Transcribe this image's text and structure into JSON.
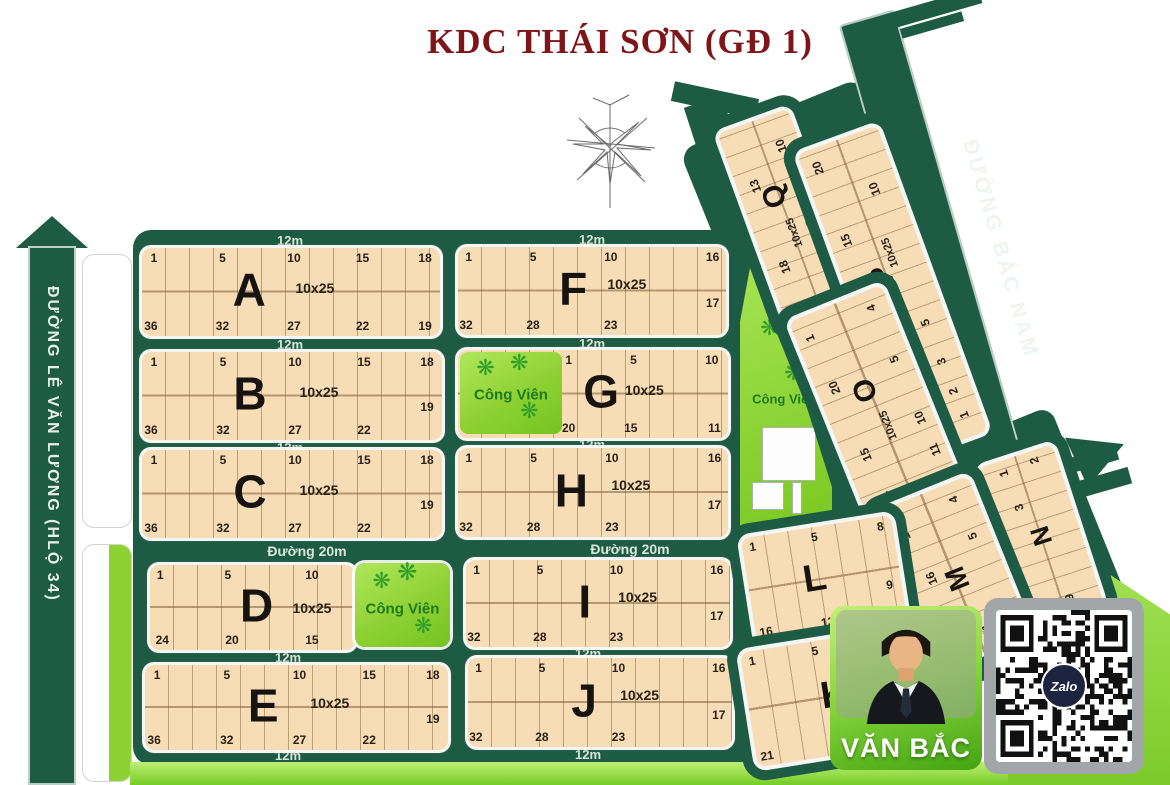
{
  "title": "KDC THÁI SƠN (GĐ 1)",
  "roads": {
    "le_van_luong": "ĐƯỜNG LÊ VĂN LƯƠNG (HLỘ 34)",
    "bac_nam": "ĐƯỜNG BẮC NAM",
    "duong_20m": "Đường 20m",
    "w12m": "12m"
  },
  "park_label": "Công Viên",
  "blocks": {
    "A": {
      "label": "A",
      "size": "10x25",
      "top": [
        "1",
        "5",
        "10",
        "15",
        "18"
      ],
      "bottom": [
        "36",
        "32",
        "27",
        "22",
        "19"
      ]
    },
    "B": {
      "label": "B",
      "size": "10x25",
      "top": [
        "1",
        "5",
        "10",
        "15",
        "18"
      ],
      "bottom": [
        "36",
        "32",
        "27",
        "22",
        "19"
      ]
    },
    "C": {
      "label": "C",
      "size": "10x25",
      "top": [
        "1",
        "5",
        "10",
        "15",
        "18"
      ],
      "bottom": [
        "36",
        "32",
        "27",
        "22",
        "19"
      ]
    },
    "D": {
      "label": "D",
      "size": "10x25",
      "top": [
        "1",
        "5",
        "10"
      ],
      "bottom": [
        "24",
        "20",
        "15"
      ]
    },
    "E": {
      "label": "E",
      "size": "10x25",
      "top": [
        "1",
        "5",
        "10",
        "15",
        "18"
      ],
      "bottom": [
        "36",
        "32",
        "27",
        "22",
        "19"
      ]
    },
    "F": {
      "label": "F",
      "size": "10x25",
      "top": [
        "1",
        "5",
        "10",
        "16"
      ],
      "bottom": [
        "32",
        "28",
        "23",
        "17"
      ]
    },
    "G": {
      "label": "G",
      "size": "10x25",
      "top": [
        "1",
        "5",
        "10"
      ],
      "bottom": [
        "20",
        "15",
        "11"
      ]
    },
    "H": {
      "label": "H",
      "size": "10x25",
      "top": [
        "1",
        "5",
        "10",
        "16"
      ],
      "bottom": [
        "32",
        "28",
        "23",
        "17"
      ]
    },
    "I": {
      "label": "I",
      "size": "10x25",
      "top": [
        "1",
        "5",
        "10",
        "16"
      ],
      "bottom": [
        "32",
        "28",
        "23",
        "17"
      ]
    },
    "J": {
      "label": "J",
      "size": "10x25",
      "top": [
        "1",
        "5",
        "10",
        "16"
      ],
      "bottom": [
        "32",
        "28",
        "23",
        "17"
      ]
    },
    "K": {
      "label": "K",
      "top": [
        "1",
        "5"
      ],
      "bottom": [
        "21",
        "13"
      ]
    },
    "L": {
      "label": "L",
      "top": [
        "1",
        "5",
        "8"
      ],
      "bottom": [
        "16",
        "13",
        "9"
      ]
    },
    "M": {
      "label": "M",
      "left": [
        "1",
        "16"
      ],
      "right": [
        "4",
        "5"
      ],
      "bottom": [
        "11"
      ]
    },
    "N": {
      "label": "N",
      "top": [
        "1",
        "2"
      ],
      "left": [
        "3"
      ],
      "bottom": [
        "9"
      ]
    },
    "O": {
      "label": "O",
      "size": "10x25",
      "left": [
        "1",
        "20",
        "15",
        "14"
      ],
      "right": [
        "4",
        "5",
        "10",
        "11"
      ]
    },
    "P": {
      "label": "P",
      "size": "10x25",
      "left": [
        "20",
        "15",
        "10"
      ],
      "right": [
        "10",
        "5",
        "3",
        "2",
        "1"
      ]
    },
    "Q": {
      "label": "Q",
      "size": "10x25",
      "left": [
        "13",
        "18",
        "1"
      ],
      "right": [
        "10",
        "5",
        "4"
      ]
    }
  },
  "agent": {
    "name": "VĂN BẮC"
  },
  "qr": {
    "logo": "Zalo"
  },
  "colors": {
    "road_green": "#1e5b45",
    "block_tan": "#f7ddb6",
    "park_green": "#8ed133",
    "title_red": "#7e1518"
  }
}
